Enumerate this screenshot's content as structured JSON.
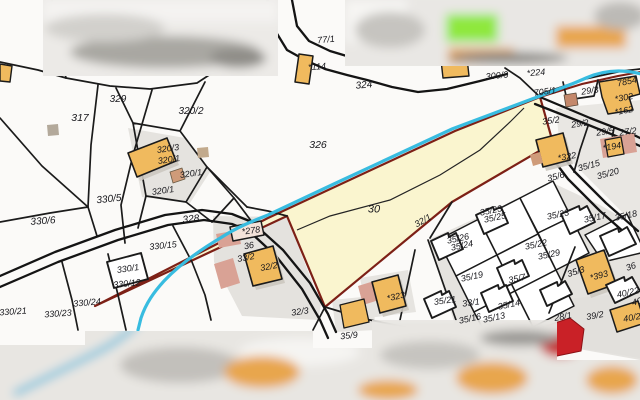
{
  "map": {
    "title": "cadastral parcel map",
    "highlighted_parcel": "30",
    "water_feature": "stream",
    "colors": {
      "bg": "#fbfaf8",
      "parcel_line": "#1b1b1b",
      "highlight_fill": "#faf5cf",
      "highlight_border": "#7d2016",
      "stream": "#38bce0",
      "building_fill": "#f0ba5e",
      "building_alt_fill": "#d9a295",
      "red_building": "#c92127",
      "grey_zone": "#e5e3df",
      "blur_green": "#8fe83e"
    },
    "labels": [
      {
        "text": "77/1",
        "x": 326,
        "y": 40,
        "rot": -6
      },
      {
        "text": "*114",
        "x": 317,
        "y": 67,
        "rot": -4
      },
      {
        "text": "324",
        "x": 364,
        "y": 86,
        "size": 10,
        "rot": -5
      },
      {
        "text": "329",
        "x": 118,
        "y": 100,
        "size": 10
      },
      {
        "text": "317",
        "x": 80,
        "y": 118,
        "size": 10.5
      },
      {
        "text": "320/2",
        "x": 191,
        "y": 112,
        "size": 10
      },
      {
        "text": "326",
        "x": 318,
        "y": 145,
        "size": 10.5
      },
      {
        "text": "320/3",
        "x": 168,
        "y": 149,
        "rot": -8
      },
      {
        "text": "320/1",
        "x": 169,
        "y": 160,
        "rot": -8
      },
      {
        "text": "320/1",
        "x": 191,
        "y": 174,
        "rot": -8
      },
      {
        "text": "320/1",
        "x": 163,
        "y": 191,
        "rot": -8
      },
      {
        "text": "330/5",
        "x": 109,
        "y": 200,
        "size": 10,
        "rot": -6
      },
      {
        "text": "330/6",
        "x": 43,
        "y": 222,
        "size": 10,
        "rot": -4
      },
      {
        "text": "328",
        "x": 191,
        "y": 220,
        "size": 10,
        "rot": -6
      },
      {
        "text": "330/15",
        "x": 163,
        "y": 246,
        "rot": -6
      },
      {
        "text": "330/1",
        "x": 128,
        "y": 269,
        "rot": -8
      },
      {
        "text": "330/12",
        "x": 127,
        "y": 284,
        "rot": -6
      },
      {
        "text": "330/24",
        "x": 87,
        "y": 303,
        "rot": -5
      },
      {
        "text": "330/21",
        "x": 13,
        "y": 312,
        "rot": -4
      },
      {
        "text": "330/23",
        "x": 58,
        "y": 314,
        "rot": -4
      },
      {
        "text": "*278",
        "x": 251,
        "y": 231,
        "rot": -8
      },
      {
        "text": "36",
        "x": 249,
        "y": 246,
        "rot": -10
      },
      {
        "text": "33/2",
        "x": 246,
        "y": 258,
        "rot": -10
      },
      {
        "text": "32/2",
        "x": 269,
        "y": 267,
        "rot": -10
      },
      {
        "text": "30",
        "x": 374,
        "y": 210,
        "size": 11
      },
      {
        "text": "32/1",
        "x": 423,
        "y": 221,
        "rot": -30
      },
      {
        "text": "32/3",
        "x": 300,
        "y": 312,
        "rot": -8
      },
      {
        "text": "*323",
        "x": 396,
        "y": 297,
        "rot": -12
      },
      {
        "text": "35/9",
        "x": 349,
        "y": 336,
        "rot": -6
      },
      {
        "text": "300/3",
        "x": 497,
        "y": 76,
        "rot": -6
      },
      {
        "text": "*224",
        "x": 536,
        "y": 73,
        "rot": -5
      },
      {
        "text": "705/1",
        "x": 545,
        "y": 92,
        "rot": -8
      },
      {
        "text": "29/3",
        "x": 590,
        "y": 91,
        "rot": -8
      },
      {
        "text": "7854",
        "x": 627,
        "y": 82,
        "rot": -12
      },
      {
        "text": "*302",
        "x": 624,
        "y": 98,
        "rot": -10
      },
      {
        "text": "*162",
        "x": 624,
        "y": 111,
        "rot": -10
      },
      {
        "text": "35/2",
        "x": 551,
        "y": 121,
        "rot": -8
      },
      {
        "text": "29/2",
        "x": 580,
        "y": 124,
        "rot": -8
      },
      {
        "text": "29/5",
        "x": 605,
        "y": 132,
        "rot": -8
      },
      {
        "text": "27/2",
        "x": 628,
        "y": 132,
        "rot": -8
      },
      {
        "text": "*194",
        "x": 612,
        "y": 147,
        "rot": -10
      },
      {
        "text": "*322",
        "x": 567,
        "y": 157,
        "rot": -10
      },
      {
        "text": "35/15",
        "x": 589,
        "y": 166,
        "rot": -15
      },
      {
        "text": "35/6",
        "x": 556,
        "y": 177,
        "rot": -15
      },
      {
        "text": "35/20",
        "x": 608,
        "y": 174,
        "rot": -15
      },
      {
        "text": "35/23",
        "x": 491,
        "y": 211,
        "rot": -12
      },
      {
        "text": "35/25",
        "x": 495,
        "y": 218,
        "rot": -12
      },
      {
        "text": "35/26",
        "x": 458,
        "y": 239,
        "rot": -12
      },
      {
        "text": "35/24",
        "x": 462,
        "y": 246,
        "rot": -12
      },
      {
        "text": "35/22",
        "x": 536,
        "y": 245,
        "rot": -12
      },
      {
        "text": "35/29",
        "x": 549,
        "y": 255,
        "rot": -12
      },
      {
        "text": "35/23",
        "x": 558,
        "y": 215,
        "rot": -12
      },
      {
        "text": "35/17",
        "x": 595,
        "y": 218,
        "rot": -12
      },
      {
        "text": "35/18",
        "x": 626,
        "y": 216,
        "rot": -12
      },
      {
        "text": "35/19",
        "x": 472,
        "y": 277,
        "rot": -12
      },
      {
        "text": "35/7",
        "x": 517,
        "y": 279,
        "rot": -12
      },
      {
        "text": "35/21",
        "x": 445,
        "y": 301,
        "rot": -8
      },
      {
        "text": "33/1",
        "x": 471,
        "y": 303,
        "rot": -8
      },
      {
        "text": "35/14",
        "x": 509,
        "y": 305,
        "rot": -12
      },
      {
        "text": "35/16",
        "x": 470,
        "y": 319,
        "rot": -12
      },
      {
        "text": "35/13",
        "x": 494,
        "y": 318,
        "rot": -12
      },
      {
        "text": "35/3",
        "x": 576,
        "y": 272,
        "rot": -18
      },
      {
        "text": "*393",
        "x": 599,
        "y": 276,
        "rot": -15
      },
      {
        "text": "36",
        "x": 631,
        "y": 267,
        "rot": -20
      },
      {
        "text": "40/22",
        "x": 628,
        "y": 293,
        "rot": -12
      },
      {
        "text": "40",
        "x": 637,
        "y": 302,
        "rot": -15
      },
      {
        "text": "39/2",
        "x": 595,
        "y": 316,
        "rot": -10
      },
      {
        "text": "28/1",
        "x": 563,
        "y": 317,
        "rot": -10
      },
      {
        "text": "40/2",
        "x": 632,
        "y": 318,
        "rot": -10
      }
    ]
  }
}
